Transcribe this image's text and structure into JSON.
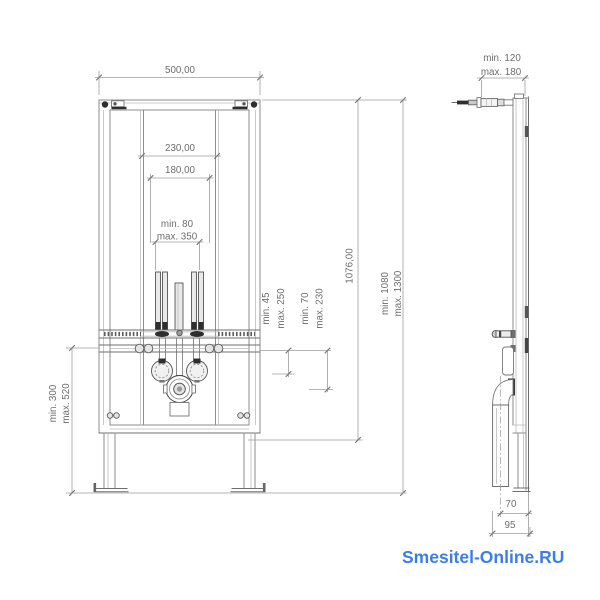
{
  "watermark": {
    "text": "Smesitel-Online.RU",
    "color": "#3d7de8"
  },
  "front_view": {
    "width": "500,00",
    "anchor_spacing": "230,00",
    "fixing_spacing": "180,00",
    "supply_min": "min. 80",
    "supply_max": "max. 350",
    "frame_height": "1076,00",
    "install_height_min": "min. 1080",
    "install_height_max": "max. 1300",
    "lower_zone_min": "min. 300",
    "lower_zone_max": "max. 520",
    "water_conn_min": "min. 45",
    "water_conn_max": "max. 250",
    "drain_offset_min": "min. 70",
    "drain_offset_max": "max. 230"
  },
  "side_view": {
    "inlet_depth_min": "min. 120",
    "inlet_depth_max": "max. 180",
    "drain_axis_offset": "70",
    "mount_depth": "95"
  }
}
